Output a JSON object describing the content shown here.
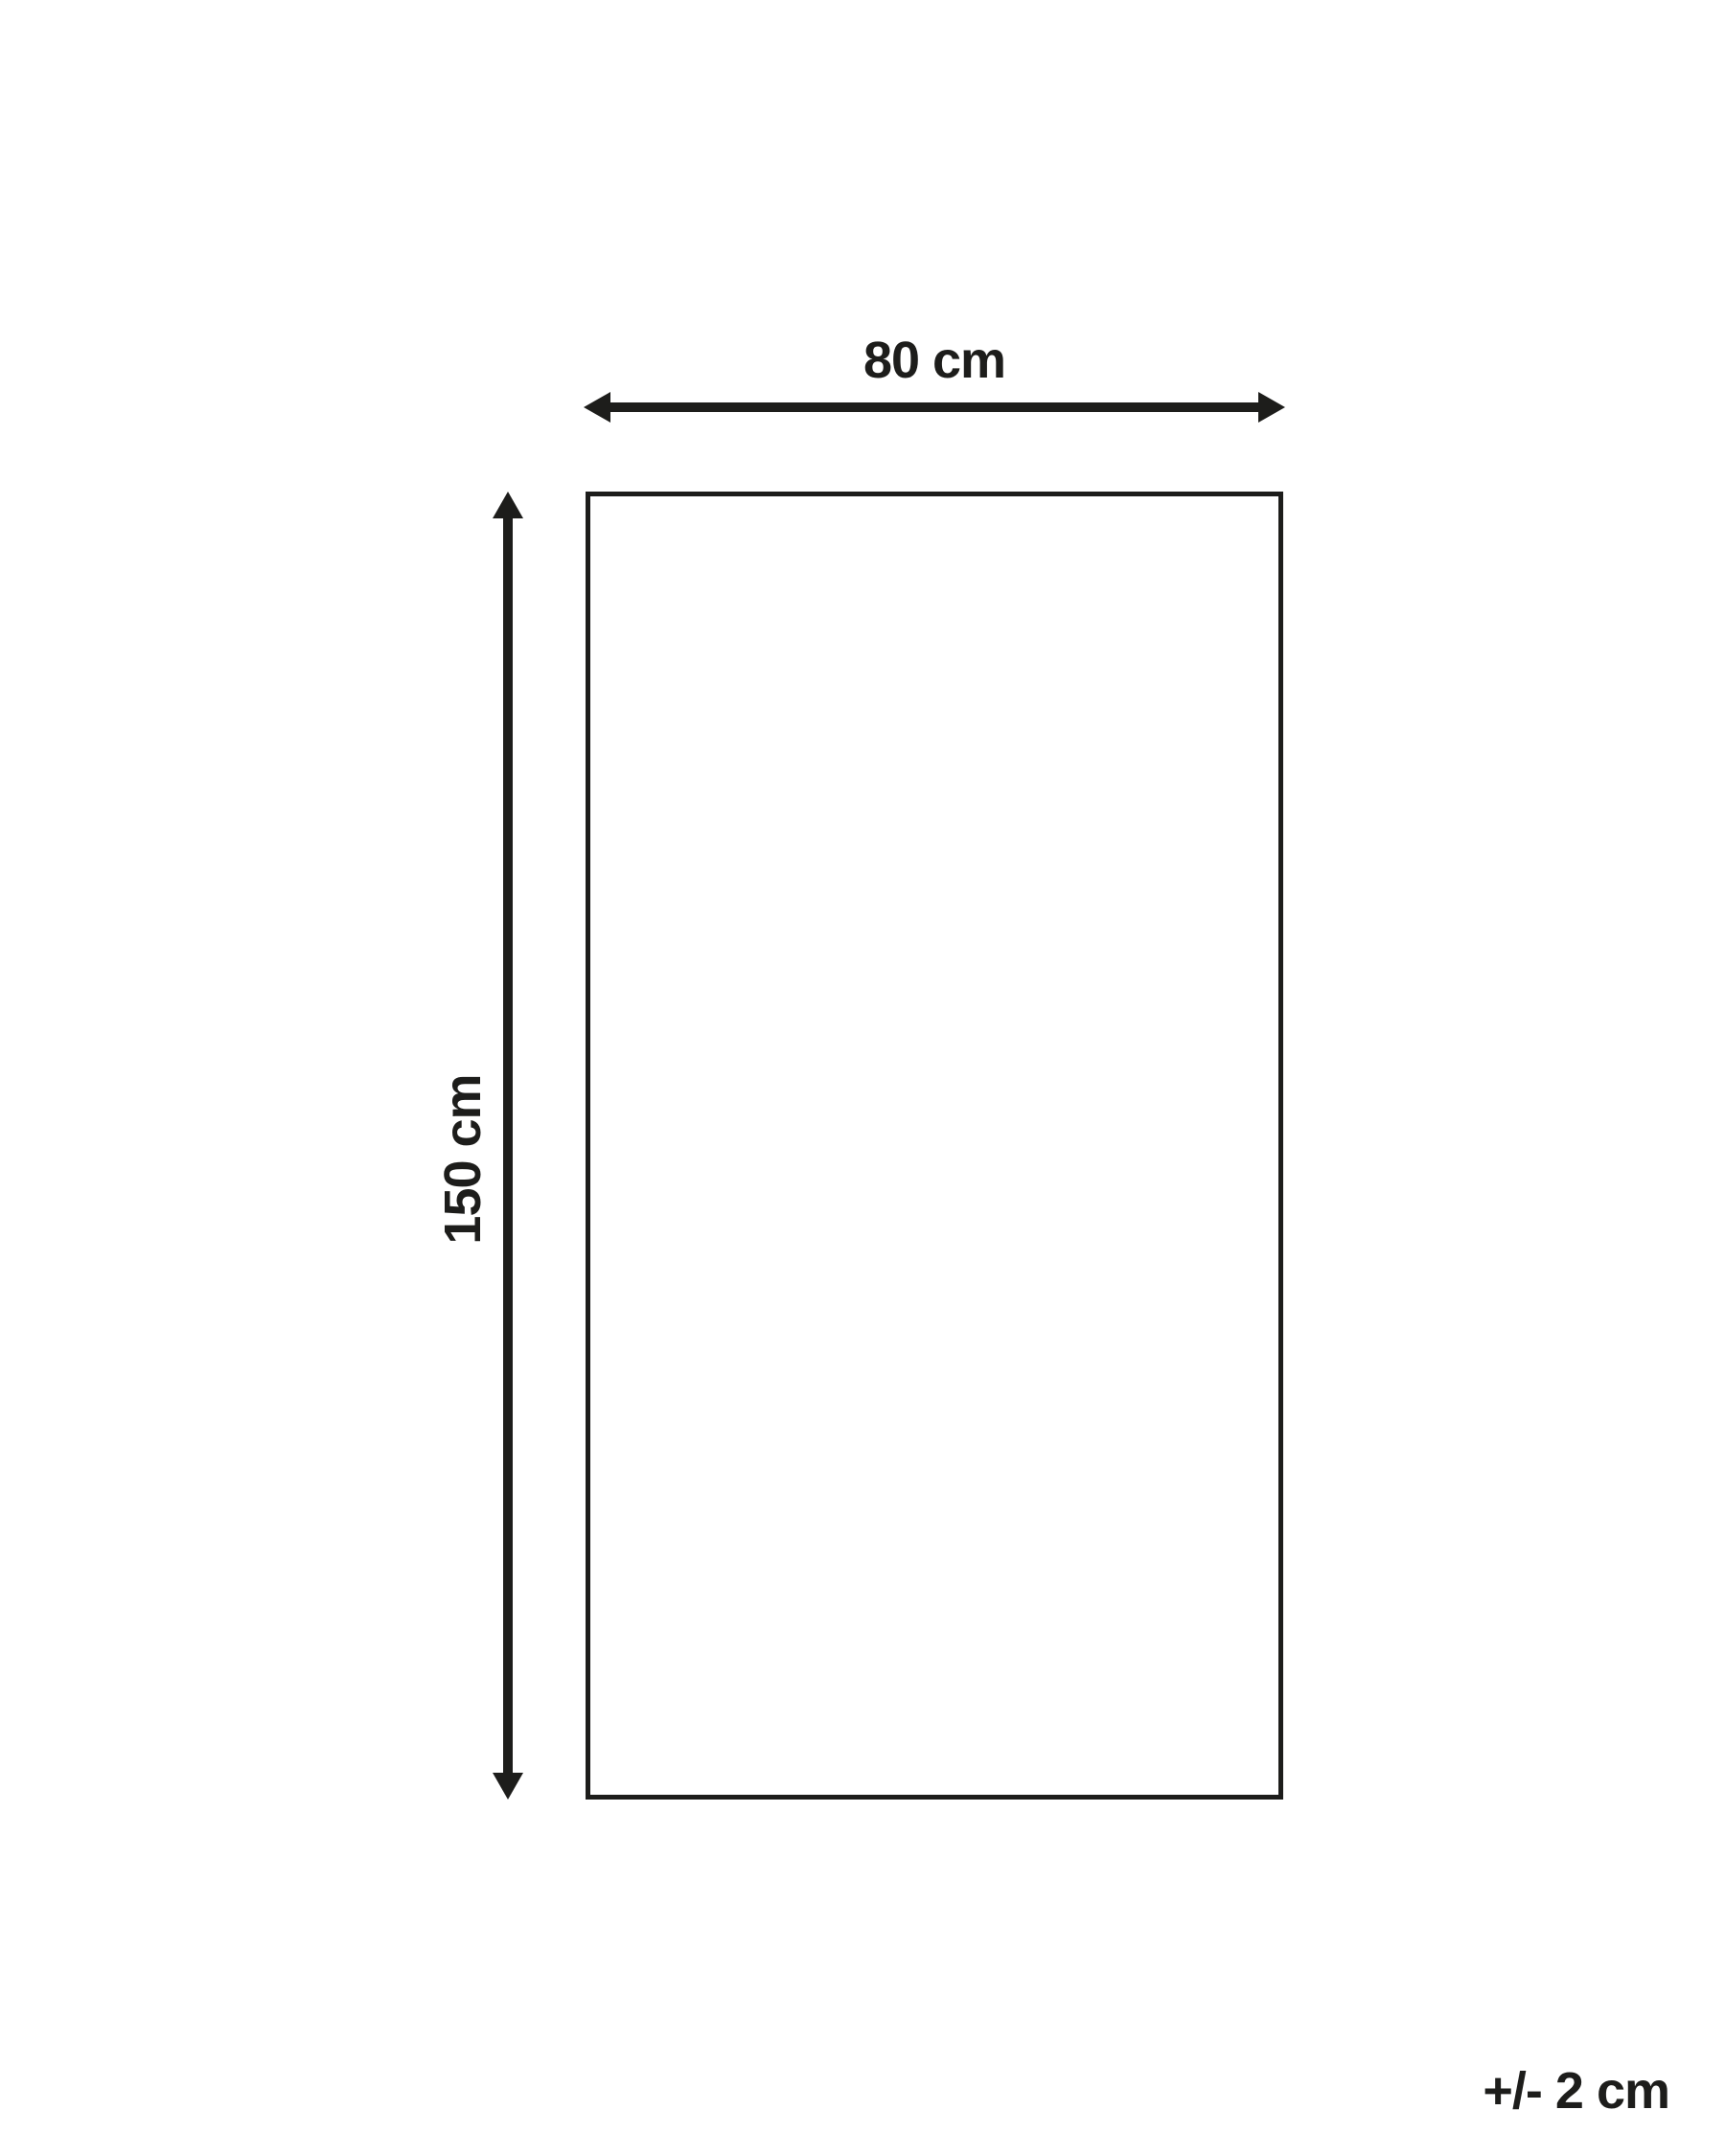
{
  "colors": {
    "ink": "#1d1d1b",
    "background": "#ffffff"
  },
  "diagram": {
    "width": {
      "label": "80 cm",
      "value_cm": 80
    },
    "height": {
      "label": "150 cm",
      "value_cm": 150
    },
    "tolerance": {
      "label": "+/- 2 cm",
      "value_cm": 2
    }
  }
}
